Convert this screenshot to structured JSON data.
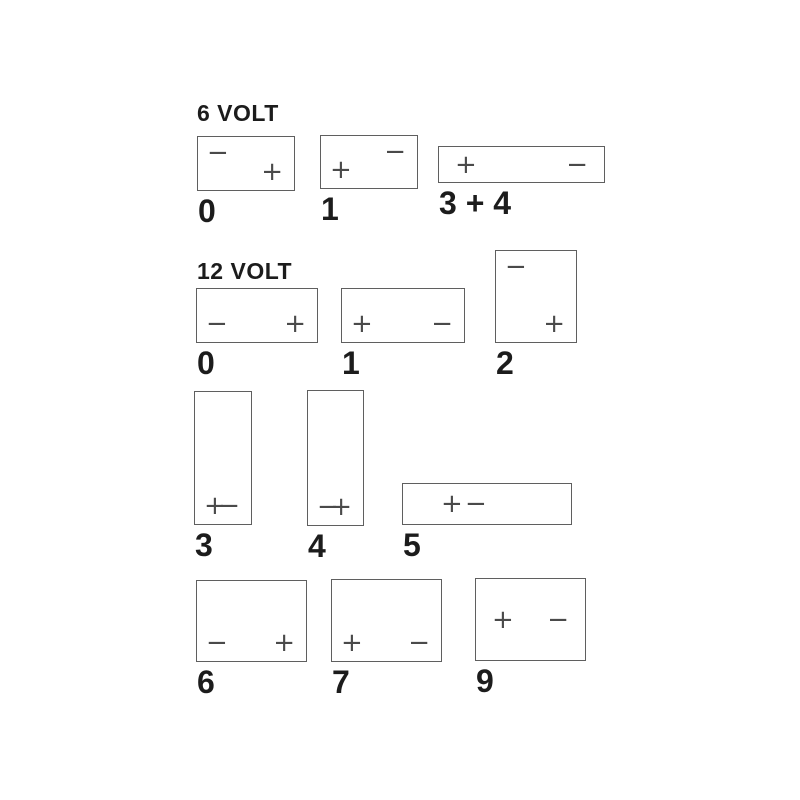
{
  "diagram": {
    "description": "Battery terminal layout codes",
    "colors": {
      "background": "#ffffff",
      "line": "#5f5f5f",
      "terminal": "#4a4a4a",
      "label": "#1c1c1c"
    },
    "sections": [
      {
        "title": "6 VOLT",
        "title_pos": {
          "x": 197,
          "y": 101
        },
        "batteries": [
          {
            "label": "0",
            "x": 197,
            "y": 136,
            "w": 98,
            "h": 55,
            "terminals": [
              {
                "sign": "−",
                "pos": "tl"
              },
              {
                "sign": "+",
                "pos": "br"
              }
            ]
          },
          {
            "label": "1",
            "x": 320,
            "y": 135,
            "w": 98,
            "h": 54,
            "terminals": [
              {
                "sign": "−",
                "pos": "tr"
              },
              {
                "sign": "+",
                "pos": "bl"
              }
            ]
          },
          {
            "label": "3 + 4",
            "x": 438,
            "y": 146,
            "w": 167,
            "h": 37,
            "terminals": [
              {
                "sign": "+",
                "pos": "ml"
              },
              {
                "sign": "−",
                "pos": "mr"
              }
            ]
          }
        ]
      },
      {
        "title": "12 VOLT",
        "title_pos": {
          "x": 197,
          "y": 259
        },
        "batteries": [
          {
            "label": "0",
            "x": 196,
            "y": 288,
            "w": 122,
            "h": 55,
            "terminals": [
              {
                "sign": "−",
                "pos": "bl"
              },
              {
                "sign": "+",
                "pos": "br"
              }
            ]
          },
          {
            "label": "1",
            "x": 341,
            "y": 288,
            "w": 124,
            "h": 55,
            "terminals": [
              {
                "sign": "+",
                "pos": "bl"
              },
              {
                "sign": "−",
                "pos": "br"
              }
            ]
          },
          {
            "label": "2",
            "x": 495,
            "y": 250,
            "w": 82,
            "h": 93,
            "terminals": [
              {
                "sign": "−",
                "pos": "tl"
              },
              {
                "sign": "+",
                "pos": "br"
              }
            ]
          },
          {
            "label": "3",
            "x": 194,
            "y": 391,
            "w": 58,
            "h": 134,
            "terminals": [
              {
                "sign": "+",
                "pos": "bl"
              },
              {
                "sign": "−",
                "pos": "br"
              }
            ]
          },
          {
            "label": "4",
            "x": 307,
            "y": 390,
            "w": 57,
            "h": 136,
            "terminals": [
              {
                "sign": "−",
                "pos": "bl"
              },
              {
                "sign": "+",
                "pos": "br"
              }
            ]
          },
          {
            "label": "5",
            "x": 402,
            "y": 483,
            "w": 170,
            "h": 42,
            "terminals": [
              {
                "sign": "+",
                "pos": "m",
                "left": 38
              },
              {
                "sign": "−",
                "pos": "m",
                "left": 62
              }
            ]
          },
          {
            "label": "6",
            "x": 196,
            "y": 580,
            "w": 111,
            "h": 82,
            "terminals": [
              {
                "sign": "−",
                "pos": "bl"
              },
              {
                "sign": "+",
                "pos": "br"
              }
            ]
          },
          {
            "label": "7",
            "x": 331,
            "y": 579,
            "w": 111,
            "h": 83,
            "terminals": [
              {
                "sign": "+",
                "pos": "bl"
              },
              {
                "sign": "−",
                "pos": "br"
              }
            ]
          },
          {
            "label": "9",
            "x": 475,
            "y": 578,
            "w": 111,
            "h": 83,
            "terminals": [
              {
                "sign": "+",
                "pos": "ml"
              },
              {
                "sign": "−",
                "pos": "mr"
              }
            ]
          }
        ]
      }
    ]
  }
}
